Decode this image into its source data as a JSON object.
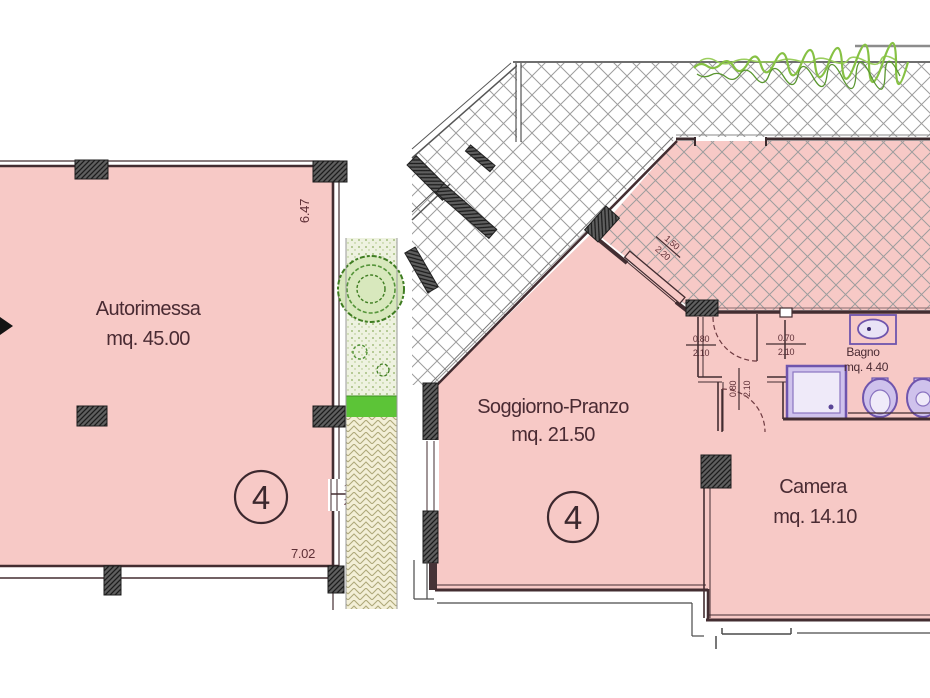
{
  "garage": {
    "name": "Autorimessa",
    "area": "mq. 45.00",
    "unit": "4",
    "dim_height": "6.47",
    "dim_width": "7.02",
    "opening_w": "1.50",
    "opening_h": "2.10"
  },
  "apartment": {
    "unit": "4",
    "living_name": "Soggiorno-Pranzo",
    "living_area": "mq. 21.50",
    "bath_name": "Bagno",
    "bath_area": "mq. 4.40",
    "bedroom_name": "Camera",
    "bedroom_area": "mq. 14.10",
    "door_hall_w": "0.80",
    "door_hall_h": "2.10",
    "door_bath_w": "0.70",
    "door_bath_h": "2.10",
    "door_bedroom_w": "0.80",
    "door_bedroom_h": "2.10",
    "terrace_door_w": "1.50",
    "terrace_door_h": "2.20"
  },
  "colors": {
    "room_fill": "#f7c9c6",
    "wall_line": "#432d31",
    "label_text": "#4a2b33",
    "fixture_purple": "#6f55ad",
    "fixture_fill": "#cfc2ec",
    "hedge_green": "#86c144",
    "grass_green": "#5cc437",
    "hatch_grey": "#9d9d9d"
  }
}
